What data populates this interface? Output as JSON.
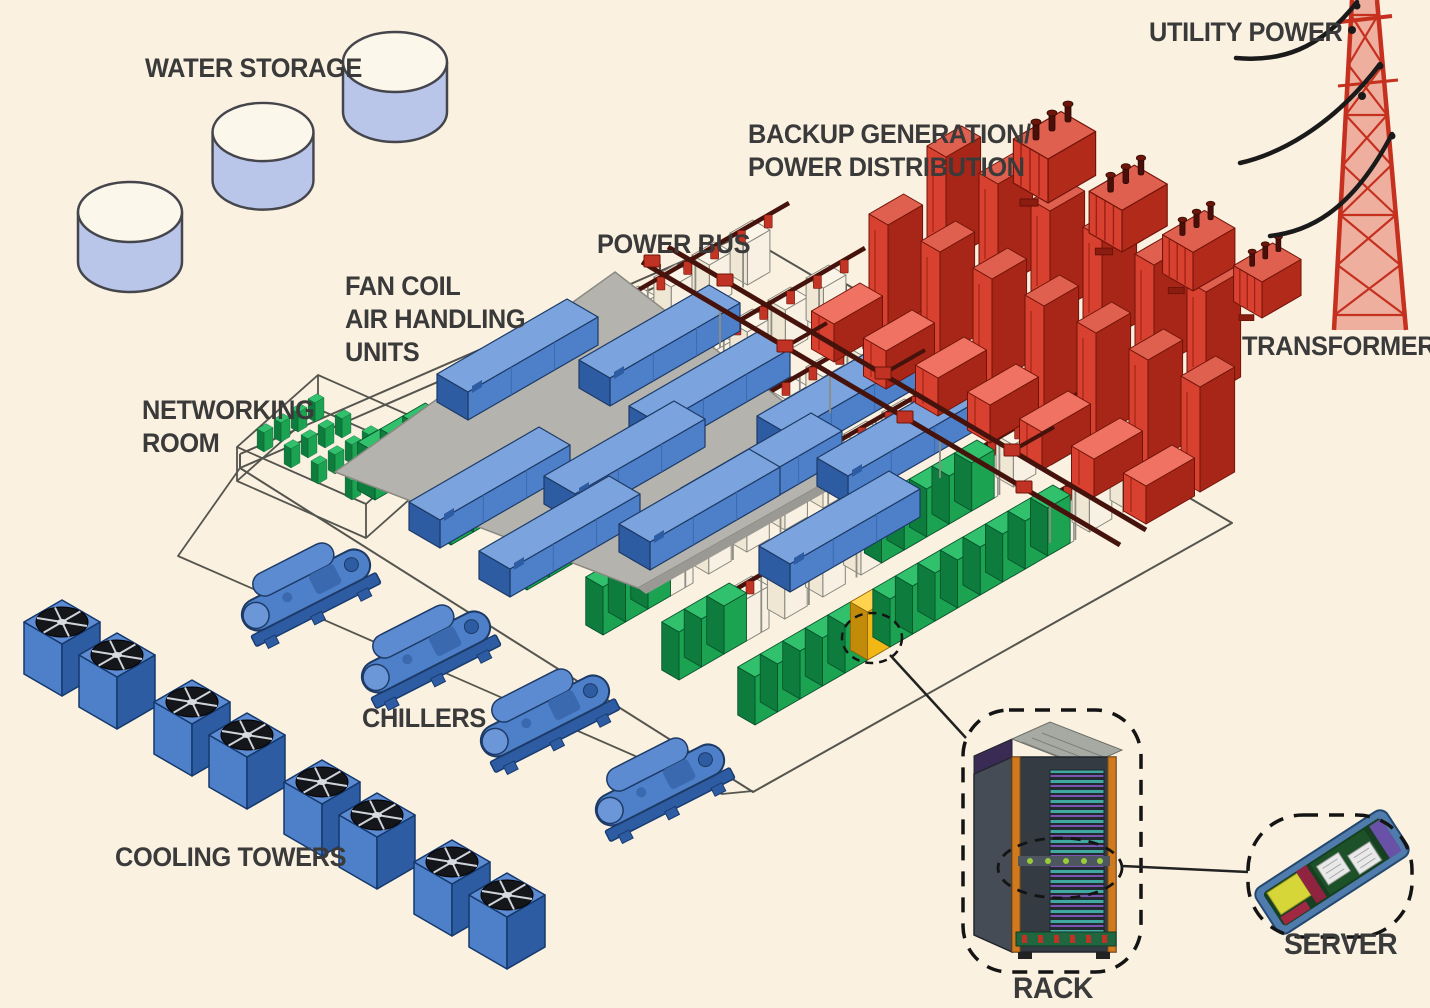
{
  "scene": {
    "background_color": "#faf1e1",
    "label_color": "#3a3a3a",
    "labels": {
      "water_storage": "WATER STORAGE",
      "utility_power": "UTILITY POWER",
      "backup_generation_1": "BACKUP GENERATION/",
      "backup_generation_2": "POWER DISTRIBUTION",
      "power_bus": "POWER BUS",
      "fan_coil_1": "FAN COIL",
      "fan_coil_2": "AIR HANDLING",
      "fan_coil_3": "UNITS",
      "networking_1": "NETWORKING",
      "networking_2": "ROOM",
      "transformers": "TRANSFORMERS",
      "chillers": "CHILLERS",
      "cooling_towers": "COOLING TOWERS",
      "rack": "RACK",
      "server": "SERVER"
    },
    "palette": {
      "power_red": "#d84130",
      "power_red_dark": "#a82617",
      "bus_maroon": "#46130c",
      "drop_red": "#c23424",
      "hvac_blue": "#4d80c8",
      "hvac_blue_dark": "#2e5ca3",
      "it_green": "#1ca351",
      "it_green_dark": "#0d7c3c",
      "highlight_yellow": "#f2b715",
      "roof_gray": "#b4b3ae",
      "tank_blue": "#b9c6ea",
      "outline_gray": "#55554e",
      "wire_black": "#1a1a1a"
    },
    "equipment_counts": {
      "water_tanks": 3,
      "transformers": 4,
      "generator_units": 13,
      "fan_coil_units": 11,
      "rack_rows": 6,
      "highlighted_racks": 1,
      "chillers": 4,
      "cooling_towers": 8
    }
  }
}
